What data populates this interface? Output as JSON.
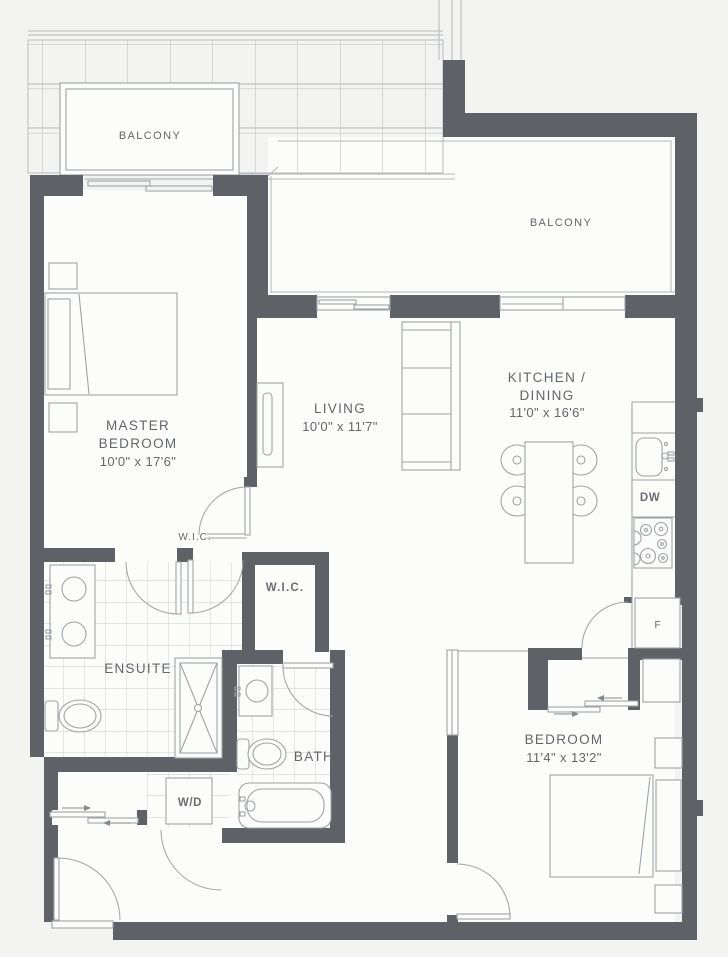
{
  "plan_title": "1 Bedroom + Den Suite Floor Plan",
  "colors": {
    "wall": "#5e6165",
    "fixture_line": "#9fa3a6",
    "tile_grid": "#c6c8ca",
    "canopy_grid": "#b8bbbd",
    "label_text": "#63666a",
    "background": "#f3f3f2",
    "room_fill": "#fcfcfb"
  },
  "rooms": {
    "balcony_left": {
      "name": "BALCONY"
    },
    "balcony_right": {
      "name": "BALCONY"
    },
    "master": {
      "name_line1": "MASTER",
      "name_line2": "BEDROOM",
      "dims": "10'0\" x 17'6\""
    },
    "living": {
      "name": "LIVING",
      "dims": "10'0\" x 11'7\""
    },
    "kitchen": {
      "name_line1": "KITCHEN /",
      "name_line2": "DINING",
      "dims": "11'0\" x 16'6\""
    },
    "bedroom": {
      "name": "BEDROOM",
      "dims": "11'4\" x 13'2\""
    },
    "ensuite": {
      "name": "ENSUITE"
    },
    "bath": {
      "name": "BATH"
    },
    "wic_hall": {
      "name": "W.I.C."
    },
    "wic_room": {
      "name": "W.I.C."
    }
  },
  "appliances": {
    "washer_dryer": "W/D",
    "dishwasher": "DW",
    "fridge": "F"
  }
}
